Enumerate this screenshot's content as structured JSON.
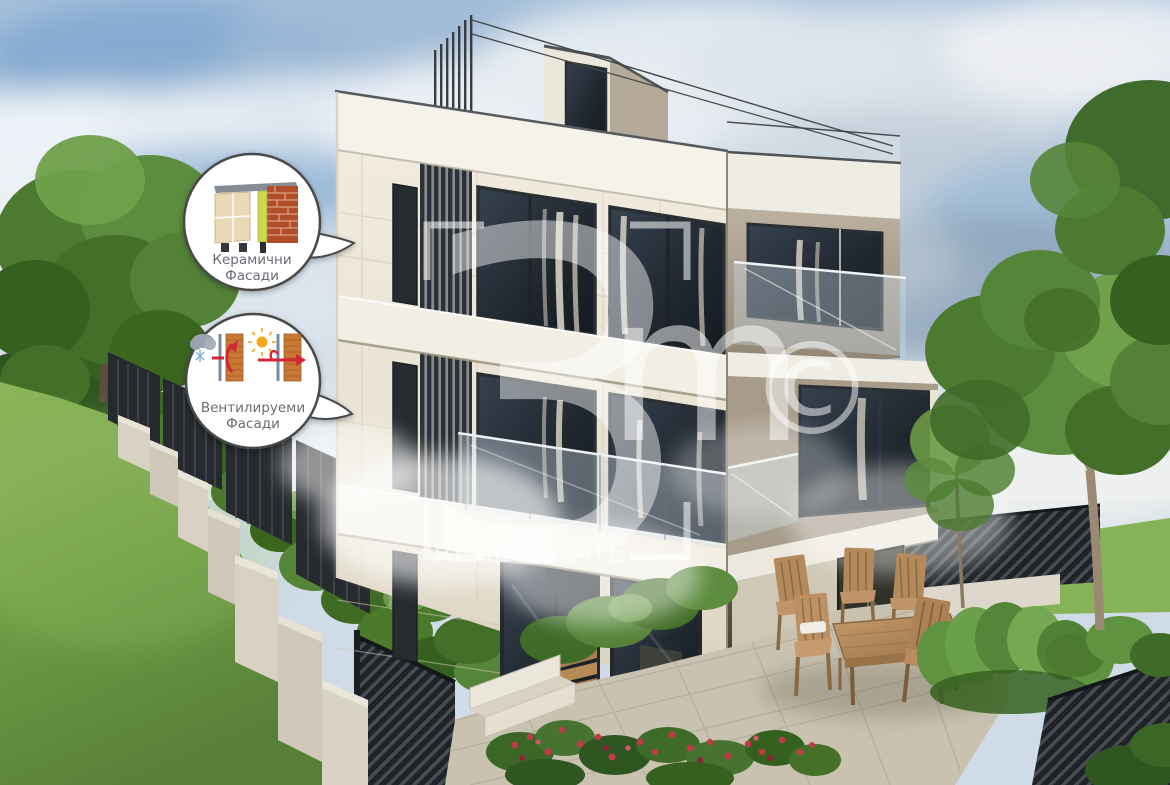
{
  "badges": {
    "ceramic": {
      "line1": "Керамични",
      "line2": "Фасади"
    },
    "ventilated": {
      "line1": "Вентилируеми",
      "line2": "Фасади"
    }
  },
  "watermark": {
    "digit": "3",
    "letter": "m",
    "copyright": "©",
    "label": "REAL ESTATE"
  },
  "colors": {
    "badge_border": "#4a4a4a",
    "badge_text": "#686d73",
    "watermark_white": "rgba(255,255,255,0.5)",
    "arrow_red": "#d42535",
    "sun_yellow": "#f2a71f",
    "brick_red": "#b24e2c",
    "brick_orange": "#c87a35",
    "insulation_green": "#c9d84d",
    "facade_cream": "#efe9dc",
    "facade_taupe": "#a89c8a",
    "grass_green": "#6d9c44",
    "sky_blue": "#a6c0dc",
    "fence_dark": "#26292d",
    "wood_brown": "#b4895c"
  }
}
